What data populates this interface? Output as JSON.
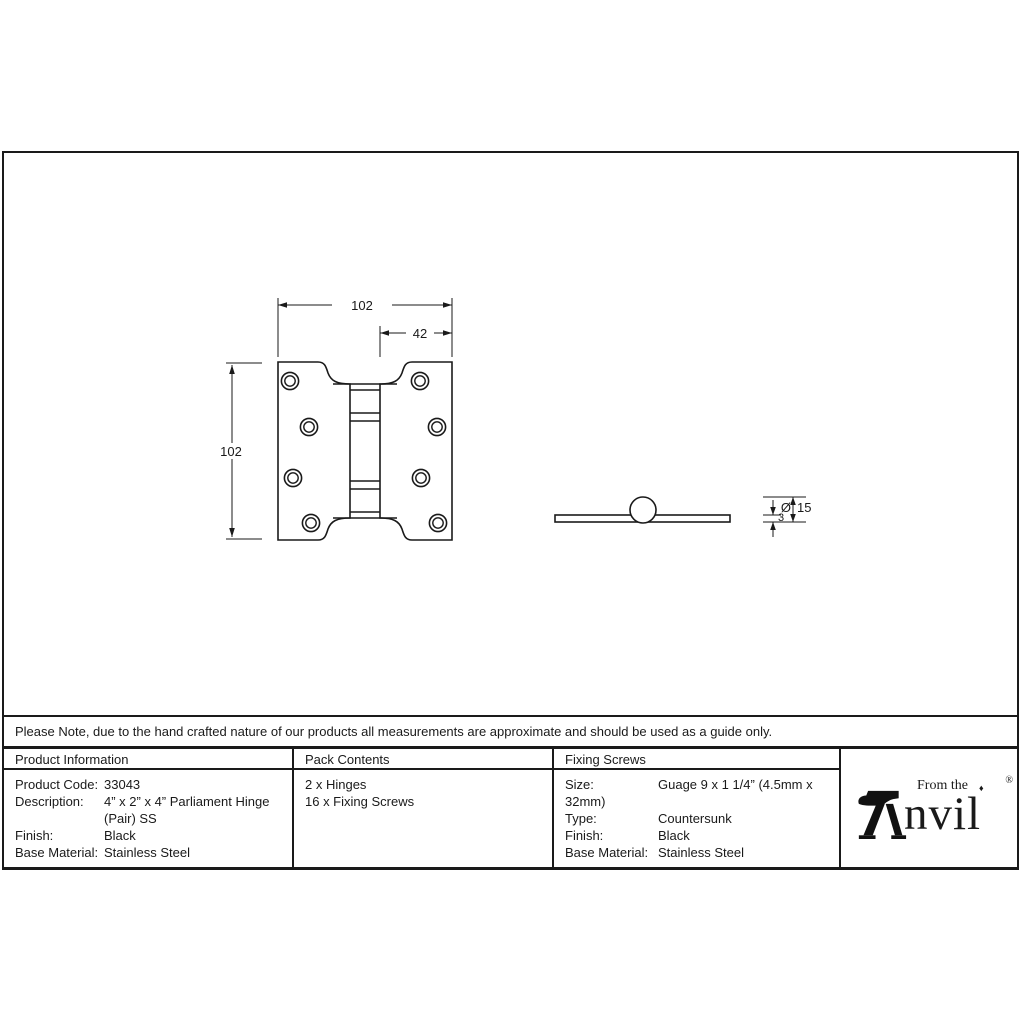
{
  "colors": {
    "ink": "#1a1a1a",
    "background": "#ffffff"
  },
  "drawing": {
    "front_view": {
      "width": "102",
      "height": "102",
      "knuckle_offset": "42"
    },
    "side_view": {
      "thickness": "3",
      "diameter_symbol": "Ø",
      "diameter_value": "15"
    }
  },
  "note": "Please Note, due to the hand crafted nature of our products all measurements are approximate and should be used as a guide only.",
  "table": {
    "product_information": {
      "header": "Product Information",
      "rows": [
        {
          "label": "Product Code:",
          "value": "33043"
        },
        {
          "label": "Description:",
          "value": "4” x 2” x 4” Parliament Hinge"
        },
        {
          "label": "",
          "value": "(Pair) SS"
        },
        {
          "label": "Finish:",
          "value": "Black"
        },
        {
          "label": "Base Material:",
          "value": "Stainless Steel"
        }
      ]
    },
    "pack_contents": {
      "header": "Pack Contents",
      "items": [
        "2 x Hinges",
        "16 x Fixing Screws"
      ]
    },
    "fixing_screws": {
      "header": "Fixing Screws",
      "rows": [
        {
          "label": "Size:",
          "value": "Guage 9 x 1 1/4” (4.5mm x 32mm)"
        },
        {
          "label": "Type:",
          "value": "Countersunk"
        },
        {
          "label": "Finish:",
          "value": "Black"
        },
        {
          "label": "Base Material:",
          "value": "Stainless Steel"
        }
      ]
    }
  },
  "logo": {
    "tagline": "From the",
    "diamond": "♦",
    "name_rest": "nvil",
    "registered": "®"
  }
}
